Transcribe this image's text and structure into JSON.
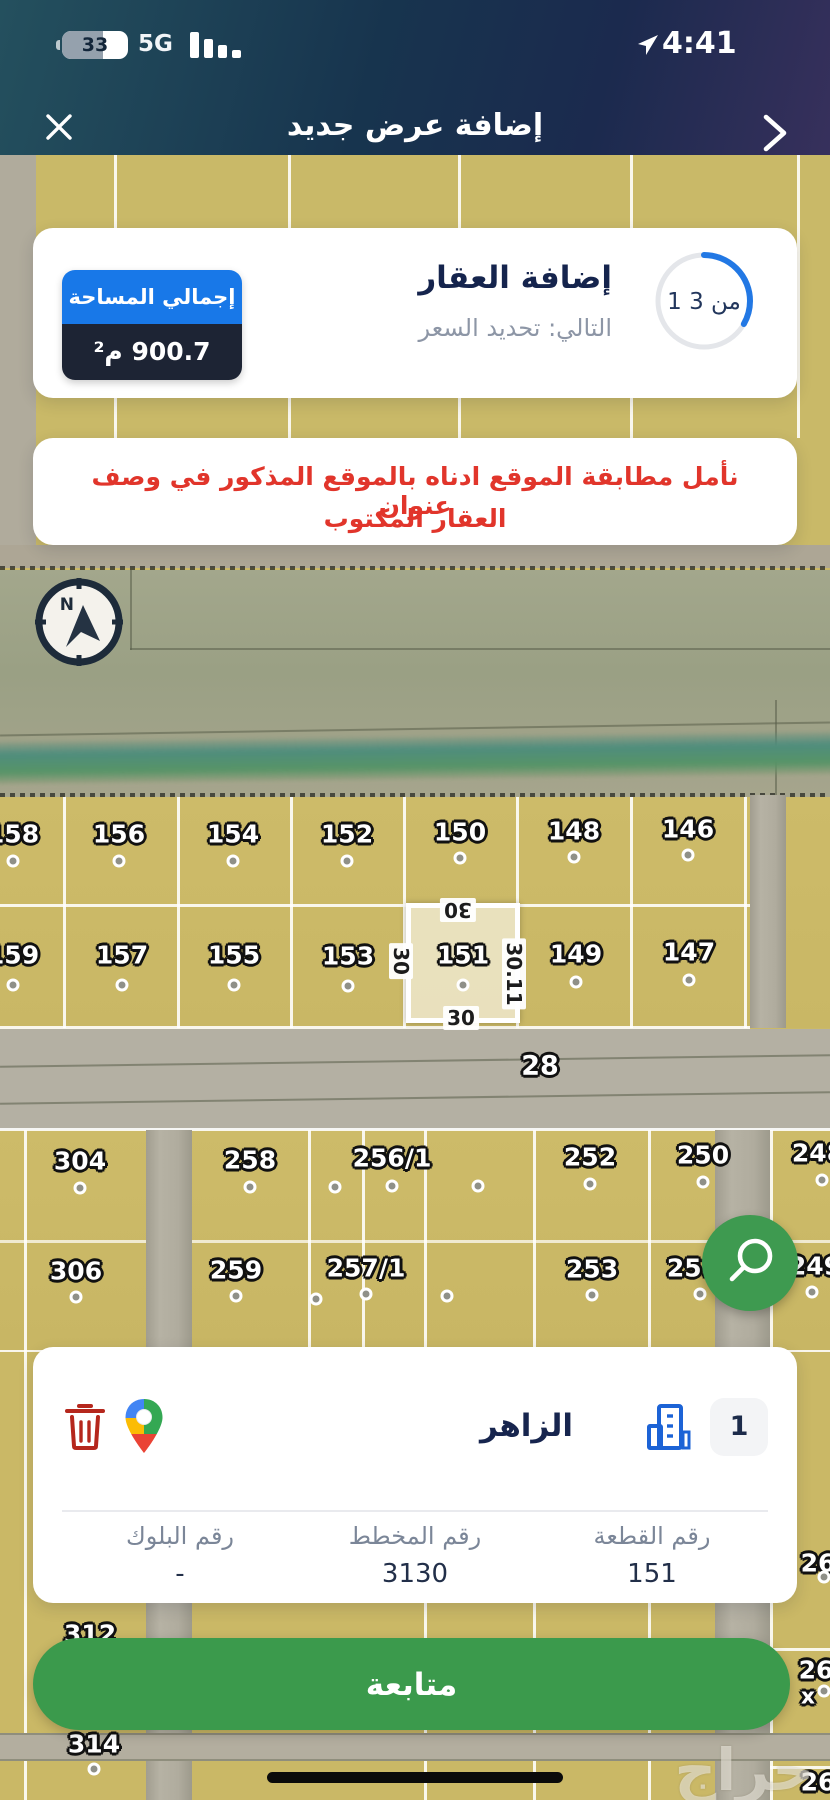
{
  "status_bar": {
    "battery": "33",
    "network": "5G",
    "time": "4:41"
  },
  "nav": {
    "title": "إضافة عرض جديد"
  },
  "progress_card": {
    "title": "إضافة العقار",
    "subtitle": "التالي: تحديد السعر",
    "progress_label": "1 من 3",
    "progress_fraction": 0.333,
    "area_badge": {
      "label": "إجمالي المساحة",
      "value": "900.7 م²",
      "label_bg": "#1878e8",
      "value_bg": "#1d2434"
    }
  },
  "warning_card": {
    "line1": "نأمل مطابقة الموقع ادناه بالموقع المذكور في وصف عنوان",
    "line2": "العقار المكتوب"
  },
  "map": {
    "compass_letter": "N",
    "street_label": "28",
    "watermark": "حراج",
    "parcels": [
      {
        "n": "158",
        "x": 13,
        "y": 834,
        "dot": [
          13,
          861
        ]
      },
      {
        "n": "156",
        "x": 119,
        "y": 834,
        "dot": [
          119,
          861
        ]
      },
      {
        "n": "154",
        "x": 233,
        "y": 834,
        "dot": [
          233,
          861
        ]
      },
      {
        "n": "152",
        "x": 347,
        "y": 834,
        "dot": [
          347,
          861
        ]
      },
      {
        "n": "150",
        "x": 460,
        "y": 832,
        "dot": [
          460,
          858
        ]
      },
      {
        "n": "148",
        "x": 574,
        "y": 831,
        "dot": [
          574,
          857
        ]
      },
      {
        "n": "146",
        "x": 688,
        "y": 829,
        "dot": [
          688,
          855
        ]
      },
      {
        "n": "159",
        "x": 13,
        "y": 955,
        "dot": [
          13,
          985
        ]
      },
      {
        "n": "157",
        "x": 122,
        "y": 955,
        "dot": [
          122,
          985
        ]
      },
      {
        "n": "155",
        "x": 234,
        "y": 955,
        "dot": [
          234,
          985
        ]
      },
      {
        "n": "153",
        "x": 348,
        "y": 956,
        "dot": [
          348,
          986
        ]
      },
      {
        "n": "149",
        "x": 576,
        "y": 954,
        "dot": [
          576,
          982
        ]
      },
      {
        "n": "147",
        "x": 689,
        "y": 952,
        "dot": [
          689,
          980
        ]
      },
      {
        "n": "304",
        "x": 80,
        "y": 1161,
        "dot": [
          80,
          1188
        ]
      },
      {
        "n": "258",
        "x": 250,
        "y": 1160,
        "dot": [
          250,
          1187
        ]
      },
      {
        "n": "256/1",
        "x": 392,
        "y": 1158,
        "dot": [
          392,
          1186
        ]
      },
      {
        "n": "252",
        "x": 590,
        "y": 1157,
        "dot": [
          590,
          1184
        ]
      },
      {
        "n": "250",
        "x": 703,
        "y": 1155,
        "dot": [
          703,
          1182
        ]
      },
      {
        "n": "248",
        "x": 818,
        "y": 1153,
        "dot": [
          822,
          1180
        ]
      },
      {
        "n": "306",
        "x": 76,
        "y": 1271,
        "dot": [
          76,
          1297
        ]
      },
      {
        "n": "259",
        "x": 236,
        "y": 1270,
        "dot": [
          236,
          1296
        ]
      },
      {
        "n": "257/1",
        "x": 366,
        "y": 1268,
        "dot": [
          366,
          1294
        ]
      },
      {
        "n": "253",
        "x": 592,
        "y": 1269,
        "dot": [
          592,
          1295
        ]
      },
      {
        "n": "251",
        "x": 693,
        "y": 1268,
        "dot": [
          700,
          1294
        ]
      },
      {
        "n": "249",
        "x": 815,
        "y": 1266,
        "dot": [
          812,
          1292
        ]
      },
      {
        "n": "312",
        "x": 90,
        "y": 1634
      },
      {
        "n": "314",
        "x": 94,
        "y": 1744,
        "dot": [
          94,
          1769
        ]
      },
      {
        "n": "26",
        "x": 818,
        "y": 1563,
        "dot": [
          824,
          1577
        ]
      },
      {
        "n": "26",
        "x": 816,
        "y": 1670,
        "dot": [
          824,
          1691
        ]
      },
      {
        "n": "26",
        "x": 818,
        "y": 1782
      }
    ],
    "extra_dots": [
      [
        335,
        1187
      ],
      [
        478,
        1186
      ],
      [
        316,
        1299
      ],
      [
        447,
        1296
      ]
    ],
    "close_marker": "x",
    "highlight": {
      "number": "151",
      "dim_top": "30",
      "dim_left": "30",
      "dim_right": "30.11",
      "dim_bottom": "30",
      "label_pos": [
        463,
        955
      ],
      "dot": [
        463,
        985
      ]
    }
  },
  "location_card": {
    "index": "1",
    "name": "الزاهر",
    "fields": [
      {
        "label": "رقم القطعة",
        "value": "151"
      },
      {
        "label": "رقم المخطط",
        "value": "3130"
      },
      {
        "label": "رقم البلوك",
        "value": "-"
      }
    ]
  },
  "continue_button": {
    "label": "متابعة"
  },
  "colors": {
    "accent_blue": "#1878e8",
    "green": "#3b9a4c",
    "warning_red": "#e1352b",
    "navy": "#15244d",
    "parcel_tan": "#cbb968"
  }
}
